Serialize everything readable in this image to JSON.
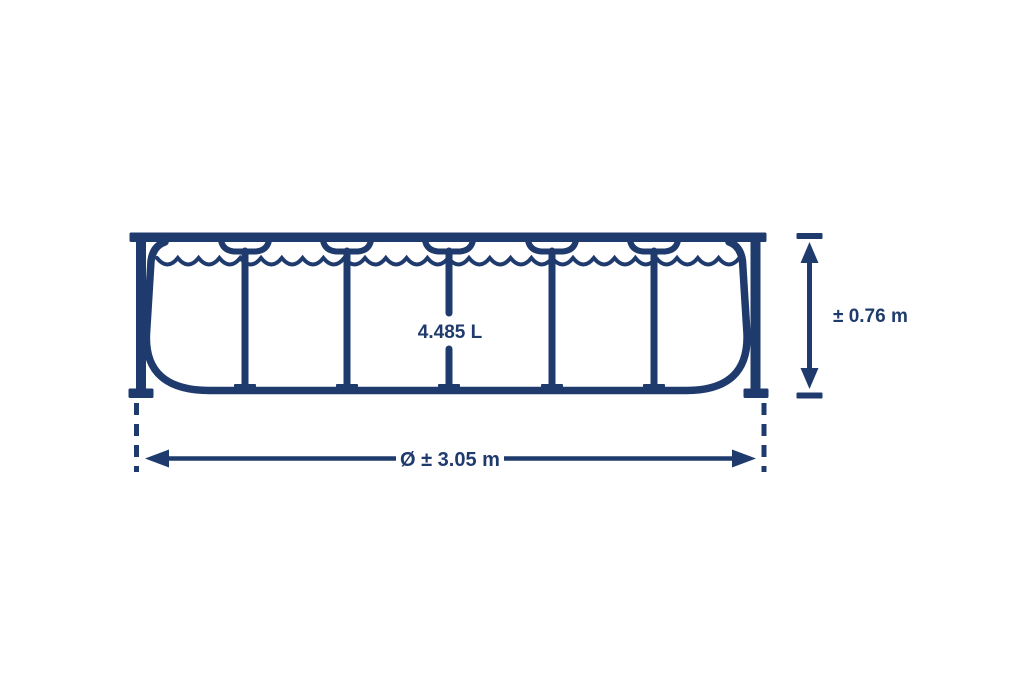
{
  "diagram": {
    "name": "frame-pool side-view dimension drawing",
    "capacity_label": "4.485 L",
    "height_label": "± 0.76 m",
    "diameter_label": "Ø ± 3.05 m"
  },
  "colors": {
    "line": "#1f3b6d",
    "background": "#ffffff"
  }
}
